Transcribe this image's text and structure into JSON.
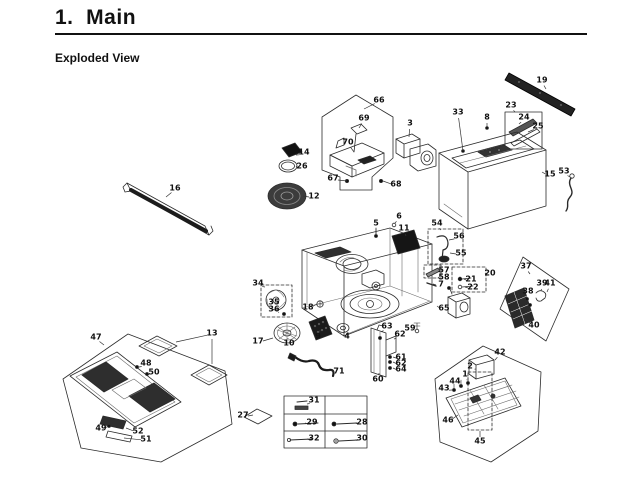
{
  "page": {
    "title": "1.  Main",
    "subtitle": "Exploded View"
  },
  "diagram": {
    "callouts": [
      {
        "n": "66",
        "x": 379,
        "y": 100,
        "t": [
          364,
          109
        ]
      },
      {
        "n": "69",
        "x": 364,
        "y": 118,
        "t": [
          359,
          128
        ]
      },
      {
        "n": "70",
        "x": 348,
        "y": 142,
        "t": [
          354,
          152
        ]
      },
      {
        "n": "3",
        "x": 410,
        "y": 123,
        "t": [
          409,
          137
        ]
      },
      {
        "n": "67",
        "x": 333,
        "y": 178,
        "t": [
          347,
          181
        ]
      },
      {
        "n": "68",
        "x": 396,
        "y": 184,
        "t": [
          383,
          181
        ]
      },
      {
        "n": "14",
        "x": 304,
        "y": 152,
        "t": [
          296,
          155
        ]
      },
      {
        "n": "26",
        "x": 302,
        "y": 166,
        "t": [
          296,
          166
        ]
      },
      {
        "n": "12",
        "x": 314,
        "y": 196,
        "t": [
          303,
          196
        ]
      },
      {
        "n": "16",
        "x": 175,
        "y": 188,
        "t": [
          166,
          197
        ]
      },
      {
        "n": "19",
        "x": 542,
        "y": 80,
        "t": [
          546,
          89
        ]
      },
      {
        "n": "23",
        "x": 511,
        "y": 105,
        "t": [
          515,
          112
        ]
      },
      {
        "n": "24",
        "x": 524,
        "y": 117,
        "t": [
          519,
          124
        ]
      },
      {
        "n": "25",
        "x": 538,
        "y": 126,
        "t": [
          528,
          132
        ]
      },
      {
        "n": "33",
        "x": 458,
        "y": 112,
        "t": [
          463,
          151
        ]
      },
      {
        "n": "8",
        "x": 487,
        "y": 117,
        "t": [
          487,
          127
        ]
      },
      {
        "n": "15",
        "x": 550,
        "y": 174,
        "t": [
          542,
          172
        ]
      },
      {
        "n": "53",
        "x": 564,
        "y": 171,
        "t": [
          570,
          177
        ]
      },
      {
        "n": "5",
        "x": 376,
        "y": 223,
        "t": [
          376,
          234
        ]
      },
      {
        "n": "6",
        "x": 399,
        "y": 216,
        "t": [
          395,
          223
        ]
      },
      {
        "n": "11",
        "x": 404,
        "y": 228,
        "t": [
          406,
          236
        ]
      },
      {
        "n": "54",
        "x": 437,
        "y": 223,
        "t": [
          441,
          230
        ]
      },
      {
        "n": "56",
        "x": 459,
        "y": 236,
        "t": [
          449,
          240
        ]
      },
      {
        "n": "55",
        "x": 461,
        "y": 253,
        "t": [
          450,
          253
        ]
      },
      {
        "n": "57",
        "x": 444,
        "y": 270,
        "t": [
          438,
          271
        ]
      },
      {
        "n": "58",
        "x": 444,
        "y": 277,
        "t": [
          438,
          277
        ]
      },
      {
        "n": "7",
        "x": 441,
        "y": 284,
        "t": [
          433,
          284
        ]
      },
      {
        "n": "20",
        "x": 490,
        "y": 273,
        "t": [
          486,
          273
        ]
      },
      {
        "n": "21",
        "x": 471,
        "y": 279,
        "t": [
          464,
          279
        ]
      },
      {
        "n": "22",
        "x": 473,
        "y": 287,
        "t": [
          465,
          287
        ]
      },
      {
        "n": "65",
        "x": 444,
        "y": 308,
        "t": [
          437,
          306
        ]
      },
      {
        "n": "37",
        "x": 526,
        "y": 266,
        "t": [
          530,
          274
        ]
      },
      {
        "n": "39",
        "x": 542,
        "y": 283,
        "t": [
          541,
          291
        ]
      },
      {
        "n": "41",
        "x": 550,
        "y": 283,
        "t": [
          547,
          292
        ]
      },
      {
        "n": "38",
        "x": 528,
        "y": 291,
        "t": [
          528,
          297
        ]
      },
      {
        "n": "40",
        "x": 534,
        "y": 325,
        "t": [
          524,
          318
        ]
      },
      {
        "n": "34",
        "x": 258,
        "y": 283,
        "t": [
          265,
          287
        ]
      },
      {
        "n": "35",
        "x": 274,
        "y": 302,
        "t": [
          277,
          299
        ]
      },
      {
        "n": "36",
        "x": 274,
        "y": 309,
        "t": [
          279,
          312
        ]
      },
      {
        "n": "18",
        "x": 308,
        "y": 307,
        "t": [
          317,
          304
        ]
      },
      {
        "n": "17",
        "x": 258,
        "y": 341,
        "t": [
          273,
          338
        ]
      },
      {
        "n": "10",
        "x": 289,
        "y": 343,
        "t": [
          288,
          338
        ]
      },
      {
        "n": "9",
        "x": 318,
        "y": 336,
        "t": [
          320,
          330
        ]
      },
      {
        "n": "4",
        "x": 347,
        "y": 336,
        "t": [
          344,
          330
        ]
      },
      {
        "n": "71",
        "x": 339,
        "y": 371,
        "t": [
          324,
          369
        ]
      },
      {
        "n": "63",
        "x": 387,
        "y": 326,
        "t": [
          381,
          332
        ]
      },
      {
        "n": "59",
        "x": 410,
        "y": 328,
        "t": [
          416,
          330
        ]
      },
      {
        "n": "62",
        "x": 400,
        "y": 334,
        "t": [
          394,
          339
        ]
      },
      {
        "n": "61",
        "x": 401,
        "y": 357,
        "t": [
          393,
          357
        ]
      },
      {
        "n": "62",
        "x": 401,
        "y": 363,
        "t": [
          393,
          362
        ]
      },
      {
        "n": "64",
        "x": 401,
        "y": 369,
        "t": [
          393,
          368
        ]
      },
      {
        "n": "60",
        "x": 378,
        "y": 379,
        "t": [
          379,
          373
        ]
      },
      {
        "n": "47",
        "x": 96,
        "y": 337,
        "t": [
          104,
          345
        ]
      },
      {
        "n": "13",
        "x": 212,
        "y": 333,
        "t": [
          176,
          342
        ],
        "t2": [
          212,
          364
        ]
      },
      {
        "n": "48",
        "x": 146,
        "y": 363,
        "t": [
          139,
          367
        ]
      },
      {
        "n": "50",
        "x": 154,
        "y": 372,
        "t": [
          148,
          374
        ]
      },
      {
        "n": "49",
        "x": 101,
        "y": 428,
        "t": [
          108,
          426
        ]
      },
      {
        "n": "52",
        "x": 138,
        "y": 431,
        "t": [
          126,
          428
        ]
      },
      {
        "n": "51",
        "x": 146,
        "y": 439,
        "t": [
          124,
          438
        ]
      },
      {
        "n": "27",
        "x": 243,
        "y": 415,
        "t": [
          253,
          415
        ]
      },
      {
        "n": "31",
        "x": 314,
        "y": 400,
        "t": [
          307,
          404
        ]
      },
      {
        "n": "29",
        "x": 312,
        "y": 422,
        "t": [
          305,
          423
        ]
      },
      {
        "n": "28",
        "x": 362,
        "y": 422,
        "t": [
          355,
          423
        ]
      },
      {
        "n": "32",
        "x": 314,
        "y": 438,
        "t": [
          307,
          439
        ]
      },
      {
        "n": "30",
        "x": 362,
        "y": 438,
        "t": [
          355,
          440
        ]
      },
      {
        "n": "42",
        "x": 500,
        "y": 352,
        "t": [
          495,
          360
        ]
      },
      {
        "n": "2",
        "x": 470,
        "y": 366,
        "t": [
          476,
          369
        ]
      },
      {
        "n": "1",
        "x": 465,
        "y": 374,
        "t": [
          467,
          380
        ]
      },
      {
        "n": "44",
        "x": 455,
        "y": 381,
        "t": [
          460,
          385
        ]
      },
      {
        "n": "43",
        "x": 444,
        "y": 388,
        "t": [
          452,
          390
        ]
      },
      {
        "n": "46",
        "x": 448,
        "y": 420,
        "t": [
          458,
          415
        ]
      },
      {
        "n": "45",
        "x": 480,
        "y": 441,
        "t": [
          480,
          431
        ]
      }
    ]
  }
}
